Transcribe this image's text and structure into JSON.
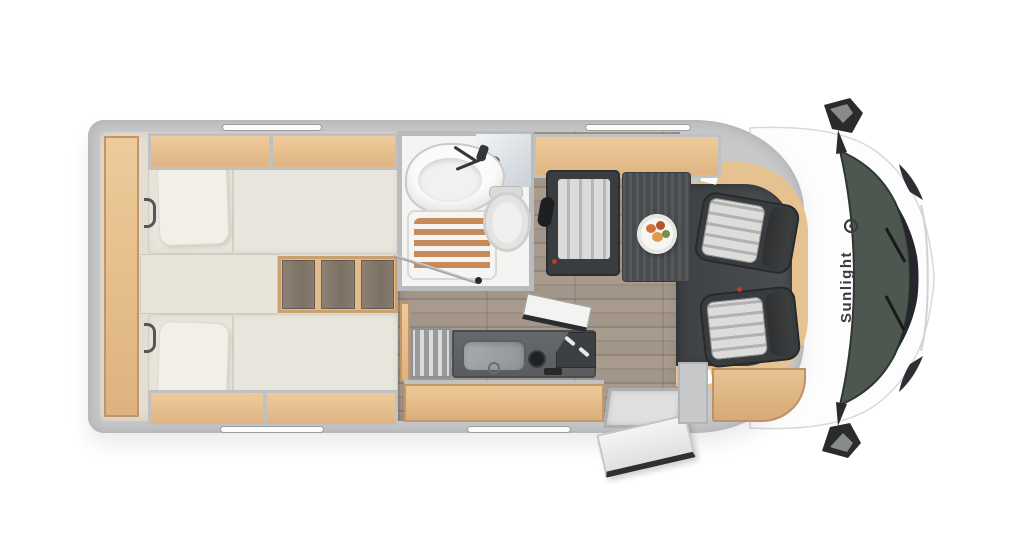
{
  "brand": {
    "label": "Sunlight"
  },
  "palette": {
    "wall": "#c6c8ca",
    "oak": "#e7c291",
    "floor_bed": "#e4ded2",
    "floor_wood": "#a2968a",
    "bed": "#e9e6dd",
    "pillow": "#f2efe7",
    "dark_gray": "#3b3e40",
    "cab_mat": "#46484b",
    "glass": "#4d564f",
    "slat": "#c78a58",
    "accent_red": "#c0392b",
    "white_body": "#fdfdfd"
  }
}
